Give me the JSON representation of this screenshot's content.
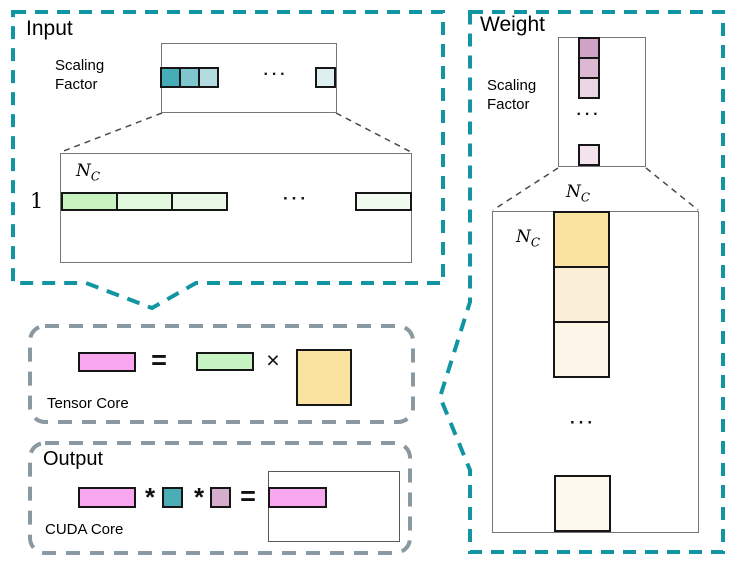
{
  "palette": {
    "teal_dash": "#1295A3",
    "gray_dash": "#8A98A1",
    "connector": "#4a4a4a"
  },
  "input": {
    "title": "Input",
    "scaling_factor_label": "Scaling\nFactor",
    "dots": "···",
    "sf_cells": [
      "#46ACB8",
      "#7FC7CE",
      "#B3DCE1"
    ],
    "sf_last_cell": "#DEEFF2",
    "matrix": {
      "row_label": "1",
      "nc": {
        "base": "N",
        "sub": "C"
      },
      "cells": [
        "#C8F3C1",
        "#E2F8DF",
        "#EAF9E7"
      ],
      "last_cell": "#F1FBEF",
      "dots": "···"
    }
  },
  "weight": {
    "title": "Weight",
    "scaling_factor_label": "Scaling\nFactor",
    "dots": "···",
    "sf_cells": [
      "#CFA3C5",
      "#DDB8D2",
      "#EAD5E3"
    ],
    "sf_last_cell": "#F3E3ED",
    "matrix": {
      "nc_top": {
        "base": "N",
        "sub": "C"
      },
      "nc_left": {
        "base": "N",
        "sub": "C"
      },
      "cells": [
        "#FAE2A1",
        "#FBEFD7",
        "#FCF5E8"
      ],
      "last_cell": "#FDF9EF",
      "dots": "···"
    }
  },
  "tensor_core": {
    "label": "Tensor Core",
    "equals": "=",
    "times": "×",
    "result_color": "#F8A7EF",
    "input_color": "#C8F3C3",
    "weight_color": "#FAE2A1"
  },
  "output": {
    "title": "Output",
    "label": "CUDA Core",
    "star1": "*",
    "star2": "*",
    "equals": "=",
    "partial_color": "#F8A7EF",
    "input_scale_color": "#4AACB4",
    "weight_scale_color": "#D5AECB",
    "result_color": "#F8A7EF"
  }
}
